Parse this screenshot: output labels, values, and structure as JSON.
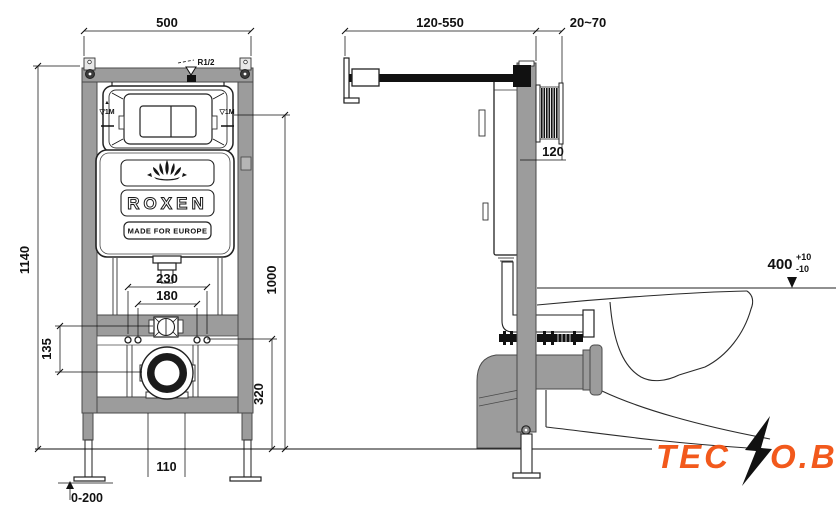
{
  "front_view": {
    "dim_width": "500",
    "dim_height": "1140",
    "dim_level_height": "1000",
    "dim_outlet_height": "320",
    "dim_bolts_outer": "230",
    "dim_bolts_inner": "180",
    "dim_bracket_offset": "135",
    "dim_pipe_width": "110",
    "dim_feet_range": "0-200",
    "label_inlet": "R1/2",
    "level_mark_left_arrow": "▲",
    "level_mark_left": "▽1M",
    "level_mark_right": "▽1M",
    "logo": {
      "brand": "ROXEN",
      "tagline": "MADE FOR EUROPE"
    }
  },
  "side_view": {
    "dim_arm_range": "120-550",
    "dim_wall_gap": "20~70",
    "dim_depth": "120",
    "dim_seat_height": "400",
    "dim_seat_tol_plus": "+10",
    "dim_seat_tol_minus": "-10"
  },
  "watermark": {
    "part1": "TEC",
    "part2": "O.BY",
    "accent_color": "#f2591c",
    "bolt_color": "#111111"
  },
  "colors": {
    "frame_gray": "#9c9c9c",
    "outline": "#222222",
    "background": "#ffffff"
  }
}
